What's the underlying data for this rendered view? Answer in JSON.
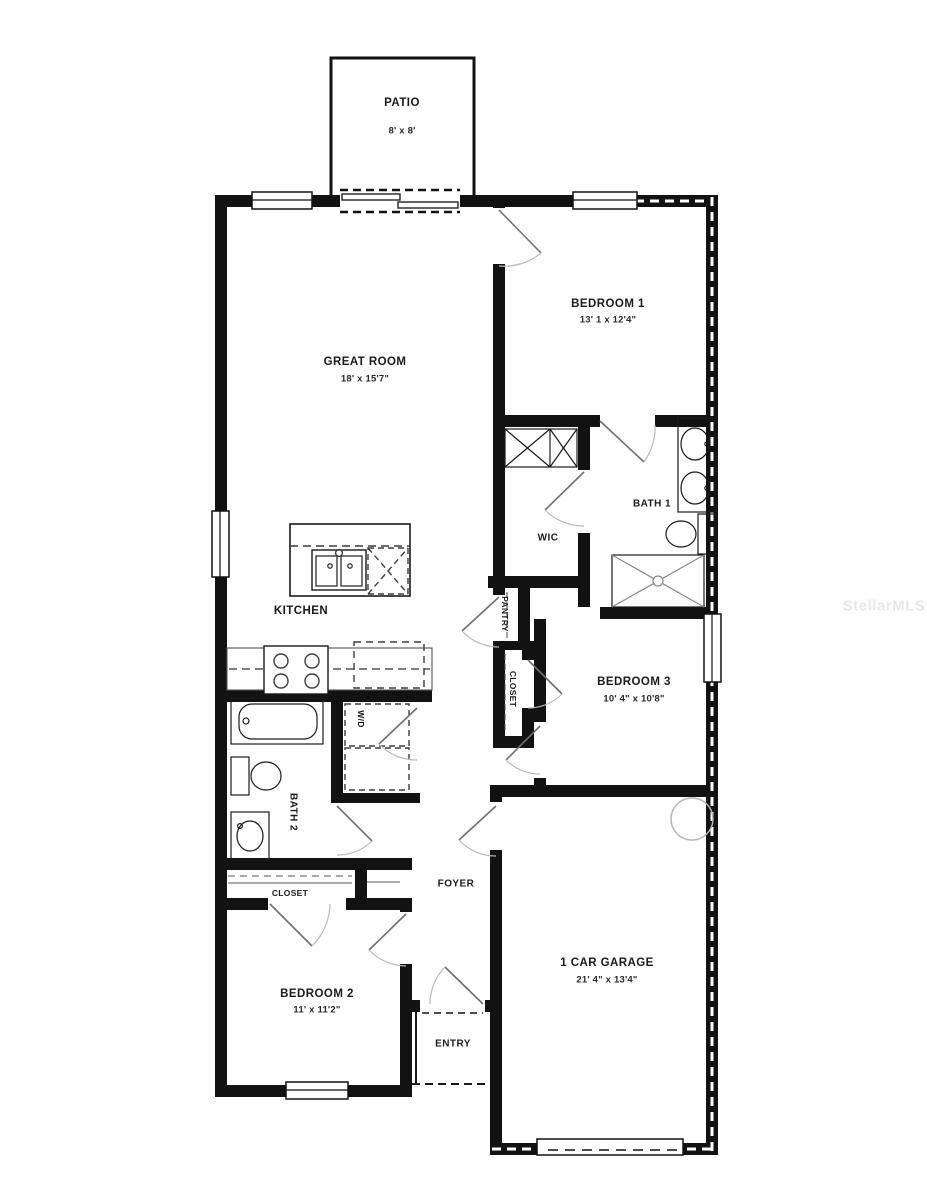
{
  "watermark": "StellarMLS",
  "floorplan": {
    "patio": {
      "name": "PATIO",
      "dims": "8' x 8'"
    },
    "great_room": {
      "name": "GREAT ROOM",
      "dims": "18' x 15'7\""
    },
    "bedroom1": {
      "name": "BEDROOM 1",
      "dims": "13' 1 x 12'4\""
    },
    "bath1": {
      "name": "BATH 1"
    },
    "wic": {
      "name": "WIC"
    },
    "kitchen": {
      "name": "KITCHEN"
    },
    "pantry": {
      "name": "PANTRY"
    },
    "closet_hall": {
      "name": "CLOSET"
    },
    "bedroom3": {
      "name": "BEDROOM 3",
      "dims": "10' 4\" x 10'8\""
    },
    "bath2": {
      "name": "BATH 2"
    },
    "washer_dryer": {
      "name": "W/D"
    },
    "foyer": {
      "name": "FOYER"
    },
    "closet_bedroom2": {
      "name": "CLOSET"
    },
    "bedroom2": {
      "name": "BEDROOM 2",
      "dims": "11' x 11'2\""
    },
    "entry": {
      "name": "ENTRY"
    },
    "garage": {
      "name": "1 CAR GARAGE",
      "dims": "21' 4\" x 13'4\""
    }
  },
  "colors": {
    "wall": "#121212",
    "background": "#ffffff",
    "door_arc": "#aaaaaa",
    "fixture": "#3d3d3d",
    "watermark": "#e7e7e7"
  }
}
